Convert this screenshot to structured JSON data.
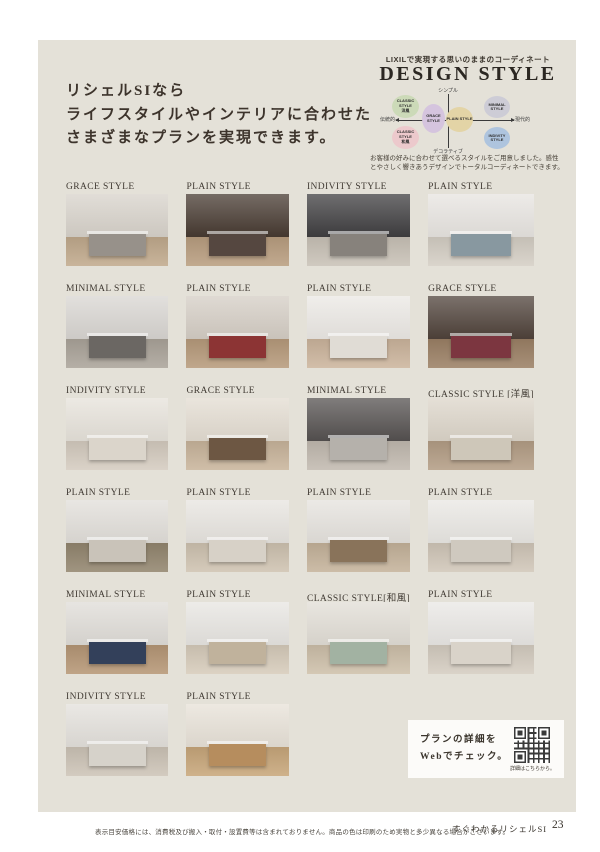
{
  "colors": {
    "page_background": "#ffffff",
    "panel_background": "#e4e1d8",
    "heading_text": "#3d342c"
  },
  "intro": {
    "line1": "リシェルSIなら",
    "line2": "ライフスタイルやインテリアに合わせた",
    "line3": "さまざまなプランを実現できます。"
  },
  "design_style": {
    "eyebrow": "LIXILで実現する思いのままのコーディネート",
    "title": "DESIGN STYLE",
    "axis": {
      "top": "シンプル",
      "bottom": "デコラティブ",
      "left": "伝統的",
      "right": "現代的"
    },
    "bubbles": [
      {
        "label": "CLASSIC STYLE",
        "sub": "洋風",
        "color": "#ccdab8",
        "pos": "top-left"
      },
      {
        "label": "MINIMAL STYLE",
        "sub": "",
        "color": "#cdccd6",
        "pos": "top-right"
      },
      {
        "label": "GRACE STYLE",
        "sub": "",
        "color": "#d5c4de",
        "pos": "mid-left"
      },
      {
        "label": "PLAIN STYLE",
        "sub": "",
        "color": "#e3d4a6",
        "pos": "center"
      },
      {
        "label": "CLASSIC STYLE",
        "sub": "和風",
        "color": "#ecc9cc",
        "pos": "bottom-left"
      },
      {
        "label": "INDIVITY STYLE",
        "sub": "",
        "color": "#aec4de",
        "pos": "bottom-right"
      }
    ],
    "desc_line1": "お客様の好みに合わせて選べるスタイルをご用意しました。感性",
    "desc_line2": "とやさしく響きあうデザインでトータルコーディネートできます。"
  },
  "gallery": {
    "photos": [
      {
        "label": "GRACE STYLE",
        "wall": "#d7d2ca",
        "floor": "#c1aa8d",
        "island": "#97918a"
      },
      {
        "label": "PLAIN STYLE",
        "wall": "#473a31",
        "floor": "#b99e80",
        "island": "#554740"
      },
      {
        "label": "INDIVITY STYLE",
        "wall": "#3f3e40",
        "floor": "#c9c2b7",
        "island": "#87827c"
      },
      {
        "label": "PLAIN STYLE",
        "wall": "#e7e4e0",
        "floor": "#d5cfc5",
        "island": "#8898a0"
      },
      {
        "label": "MINIMAL STYLE",
        "wall": "#d8d5d1",
        "floor": "#aba49a",
        "island": "#6b6763"
      },
      {
        "label": "PLAIN STYLE",
        "wall": "#d4cdc4",
        "floor": "#b79b7c",
        "island": "#8c3434"
      },
      {
        "label": "PLAIN STYLE",
        "wall": "#ebe8e4",
        "floor": "#ccb59d",
        "island": "#e0dcd5"
      },
      {
        "label": "GRACE STYLE",
        "wall": "#4f423a",
        "floor": "#9c8166",
        "island": "#7c3640"
      },
      {
        "label": "INDIVITY STYLE",
        "wall": "#e6e2da",
        "floor": "#d5ccc0",
        "island": "#dbd5cb"
      },
      {
        "label": "GRACE STYLE",
        "wall": "#e3dcd1",
        "floor": "#c9b59c",
        "island": "#6d5743"
      },
      {
        "label": "MINIMAL STYLE",
        "wall": "#555150",
        "floor": "#c2bab0",
        "island": "#b5b1ab"
      },
      {
        "label": "CLASSIC STYLE [洋風]",
        "wall": "#dcd5c9",
        "floor": "#b49e86",
        "island": "#cec7b9"
      },
      {
        "label": "PLAIN STYLE",
        "wall": "#e1ded9",
        "floor": "#93866f",
        "island": "#c9c3b9"
      },
      {
        "label": "PLAIN STYLE",
        "wall": "#e7e4df",
        "floor": "#cfc3b1",
        "island": "#d7d1c7"
      },
      {
        "label": "PLAIN STYLE",
        "wall": "#e5e2dd",
        "floor": "#c5b39b",
        "island": "#89735a"
      },
      {
        "label": "PLAIN STYLE",
        "wall": "#e9e7e3",
        "floor": "#d1c7b9",
        "island": "#cfc9bf"
      },
      {
        "label": "MINIMAL STYLE",
        "wall": "#dfdcd7",
        "floor": "#b69776",
        "island": "#33405a"
      },
      {
        "label": "PLAIN STYLE",
        "wall": "#e7e5e1",
        "floor": "#d7ccbb",
        "island": "#c0b29c"
      },
      {
        "label": "CLASSIC STYLE[和風]",
        "wall": "#e1ddd5",
        "floor": "#cec0aa",
        "island": "#a2b2a2"
      },
      {
        "label": "PLAIN STYLE",
        "wall": "#e9e7e4",
        "floor": "#d5cdc1",
        "island": "#d9d3c9"
      },
      {
        "label": "INDIVITY STYLE",
        "wall": "#e3e0db",
        "floor": "#cdc4b7",
        "island": "#d6d2ca"
      },
      {
        "label": "PLAIN STYLE",
        "wall": "#e7e1d7",
        "floor": "#c8a77b",
        "island": "#b68d5e"
      }
    ]
  },
  "plan_box": {
    "line1": "プランの詳細を",
    "line2": "Webでチェック。",
    "qr_caption": "詳細はこちらから。"
  },
  "footer": {
    "note": "表示目安価格には、消費税及び搬入・取付・設置費等は含まれておりません。商品の色は印刷のため実物と多少異なる場合がございます。",
    "booklet": "すぐわかるリシェルSI",
    "page_number": "23"
  }
}
